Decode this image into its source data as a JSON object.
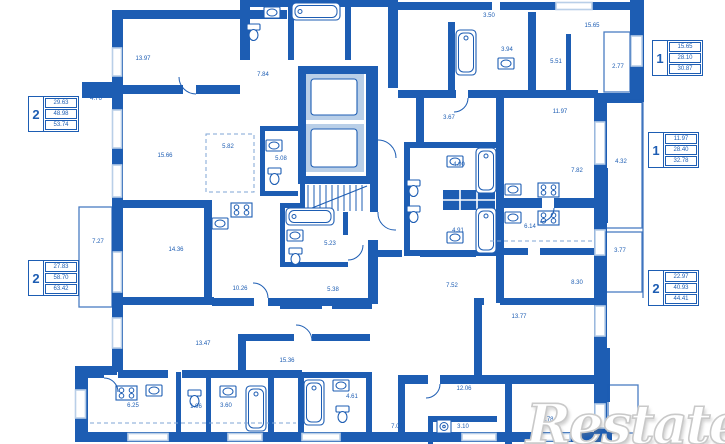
{
  "colors": {
    "wall": "#1d5db3",
    "window": "#b9cfe8",
    "dashed": "#7fa6d6",
    "watermark_outline": "#c9c9c9"
  },
  "watermark": {
    "text": "Restate"
  },
  "apartment_tables": [
    {
      "rooms": "2",
      "values": [
        "29.63",
        "48.98",
        "53.74"
      ]
    },
    {
      "rooms": "2",
      "values": [
        "27.83",
        "58.70",
        "63.42"
      ]
    },
    {
      "rooms": "1",
      "values": [
        "15.65",
        "28.10",
        "30.87"
      ]
    },
    {
      "rooms": "1",
      "values": [
        "11.97",
        "28.40",
        "32.78"
      ]
    },
    {
      "rooms": "2",
      "values": [
        "22.97",
        "40.93",
        "44.41"
      ]
    }
  ],
  "room_labels": [
    {
      "text": "13.97",
      "x": 143,
      "y": 60
    },
    {
      "text": "7.84",
      "x": 263,
      "y": 76
    },
    {
      "text": "15.66",
      "x": 165,
      "y": 157
    },
    {
      "text": "5.82",
      "x": 228,
      "y": 148
    },
    {
      "text": "5.08",
      "x": 281,
      "y": 160
    },
    {
      "text": "4.76",
      "x": 96,
      "y": 100
    },
    {
      "text": "14.36",
      "x": 176,
      "y": 251
    },
    {
      "text": "10.26",
      "x": 240,
      "y": 290
    },
    {
      "text": "7.27",
      "x": 98,
      "y": 243
    },
    {
      "text": "13.47",
      "x": 203,
      "y": 345
    },
    {
      "text": "15.36",
      "x": 287,
      "y": 362
    },
    {
      "text": "6.25",
      "x": 133,
      "y": 407
    },
    {
      "text": "1.96",
      "x": 196,
      "y": 408
    },
    {
      "text": "3.60",
      "x": 226,
      "y": 407
    },
    {
      "text": "4.61",
      "x": 352,
      "y": 398
    },
    {
      "text": "7.01",
      "x": 397,
      "y": 428
    },
    {
      "text": "5.23",
      "x": 330,
      "y": 245
    },
    {
      "text": "5.38",
      "x": 333,
      "y": 291
    },
    {
      "text": "3.50",
      "x": 489,
      "y": 17
    },
    {
      "text": "3.94",
      "x": 507,
      "y": 51
    },
    {
      "text": "15.65",
      "x": 592,
      "y": 27
    },
    {
      "text": "5.51",
      "x": 556,
      "y": 63
    },
    {
      "text": "2.77",
      "x": 618,
      "y": 68
    },
    {
      "text": "3.67",
      "x": 449,
      "y": 119
    },
    {
      "text": "11.97",
      "x": 560,
      "y": 113
    },
    {
      "text": "4.32",
      "x": 621,
      "y": 163
    },
    {
      "text": "4.90",
      "x": 459,
      "y": 166
    },
    {
      "text": "7.82",
      "x": 577,
      "y": 172
    },
    {
      "text": "4.91",
      "x": 458,
      "y": 232
    },
    {
      "text": "6.14",
      "x": 530,
      "y": 228
    },
    {
      "text": "3.77",
      "x": 620,
      "y": 252
    },
    {
      "text": "7.52",
      "x": 452,
      "y": 287
    },
    {
      "text": "8.30",
      "x": 577,
      "y": 284
    },
    {
      "text": "13.77",
      "x": 519,
      "y": 318
    },
    {
      "text": "12.06",
      "x": 464,
      "y": 390
    },
    {
      "text": "3.10",
      "x": 463,
      "y": 428
    },
    {
      "text": "10.78",
      "x": 546,
      "y": 421
    }
  ]
}
